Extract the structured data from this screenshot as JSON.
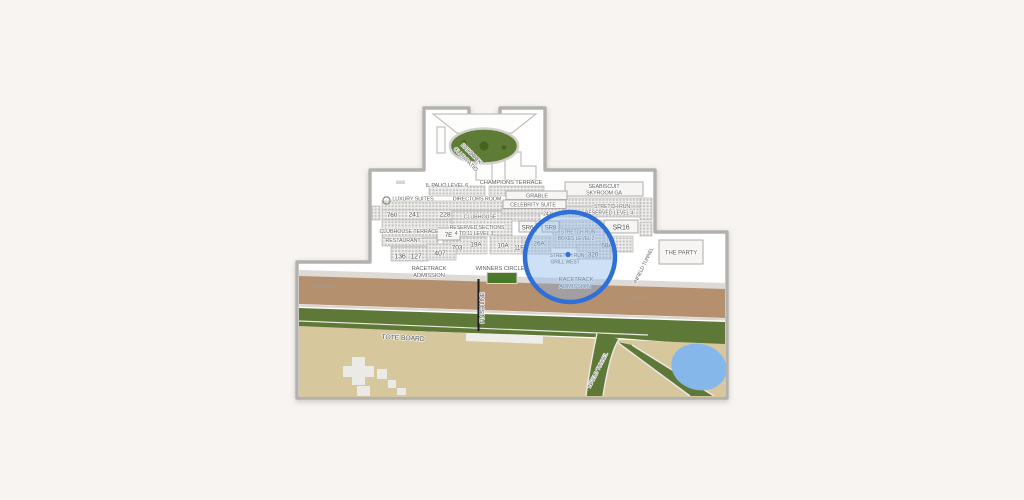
{
  "page": {
    "background_color": "#f7f4f1"
  },
  "colors": {
    "map_outline": "#b3b1ae",
    "highlight_stroke": "#2e6fd8",
    "highlight_fill": "#8ab4e8",
    "dirt_track": "#b5906e",
    "turf_track": "#5e7837",
    "infield": "#d6c79d",
    "pond": "#85b7ea",
    "paddock_green": "#5f7c36",
    "winners_circle_green": "#4c782c",
    "apron": "#dedad5"
  },
  "map": {
    "paddock": {
      "line1": "PADDOCK",
      "line2": "CLUB/PATIO"
    },
    "areas": {
      "il_palio": "IL PALIO LEVEL 6",
      "champions_terrace": "CHAMPIONS TERRACE",
      "seabiscuit_line1": "SEABISCUIT",
      "seabiscuit_line2": "SKYROOM GA",
      "luxury_suites": "LUXURY SUITES",
      "directors_room": "DIRECTORS ROOM",
      "grable": "GRABLE",
      "celebrity_suite": "CELEBRITY SUITE",
      "clubhouse": "CLUBHOUSE",
      "reserved_line1": "RESERVED SECTIONS",
      "reserved_line2": "4 TO 11 LEVEL 3",
      "clubhouse_terrace": "CLUBHOUSE TERRACE",
      "restaurant": "RESTAURANT",
      "stretch_run_reserved_line1": "STRETCH RUN",
      "stretch_run_reserved_line2": "RESERVED LEVEL 4",
      "stretch_run_boxes_line1": "STRETCH RUN",
      "stretch_run_boxes_line2": "BOXES LEVEL 2",
      "stretch_run_grill_line1": "STRETCH RUN",
      "stretch_run_grill_line2": "GRILL WEST",
      "the_party": "THE PARTY"
    },
    "sections": {
      "s760": "760",
      "s241": "241",
      "s228": "228",
      "s136": "136",
      "s127": "127",
      "s407": "407",
      "s703": "703",
      "s7e": "7E",
      "s19a": "19A",
      "s10a": "10A",
      "s11f": "11F",
      "s26a": "26A",
      "s58a": "58A",
      "s320": "320",
      "s24j": "24J",
      "s41j": "41J",
      "sr6": "SR6",
      "sr8": "SR8",
      "sr16": "SR16"
    },
    "track": {
      "racetrack_admission_line1": "RACETRACK",
      "racetrack_admission_line2": "ADMISSION",
      "winners_circle": "WINNERS CIRCLE",
      "finish_line": "FINISH LINE",
      "tote_board": "TOTE BOARD",
      "infield_tunnel": "INFIELD TUNNEL",
      "pole_left": "◄ 1/8 POLE",
      "pole_right": "◄ 1/8 POLE"
    }
  }
}
